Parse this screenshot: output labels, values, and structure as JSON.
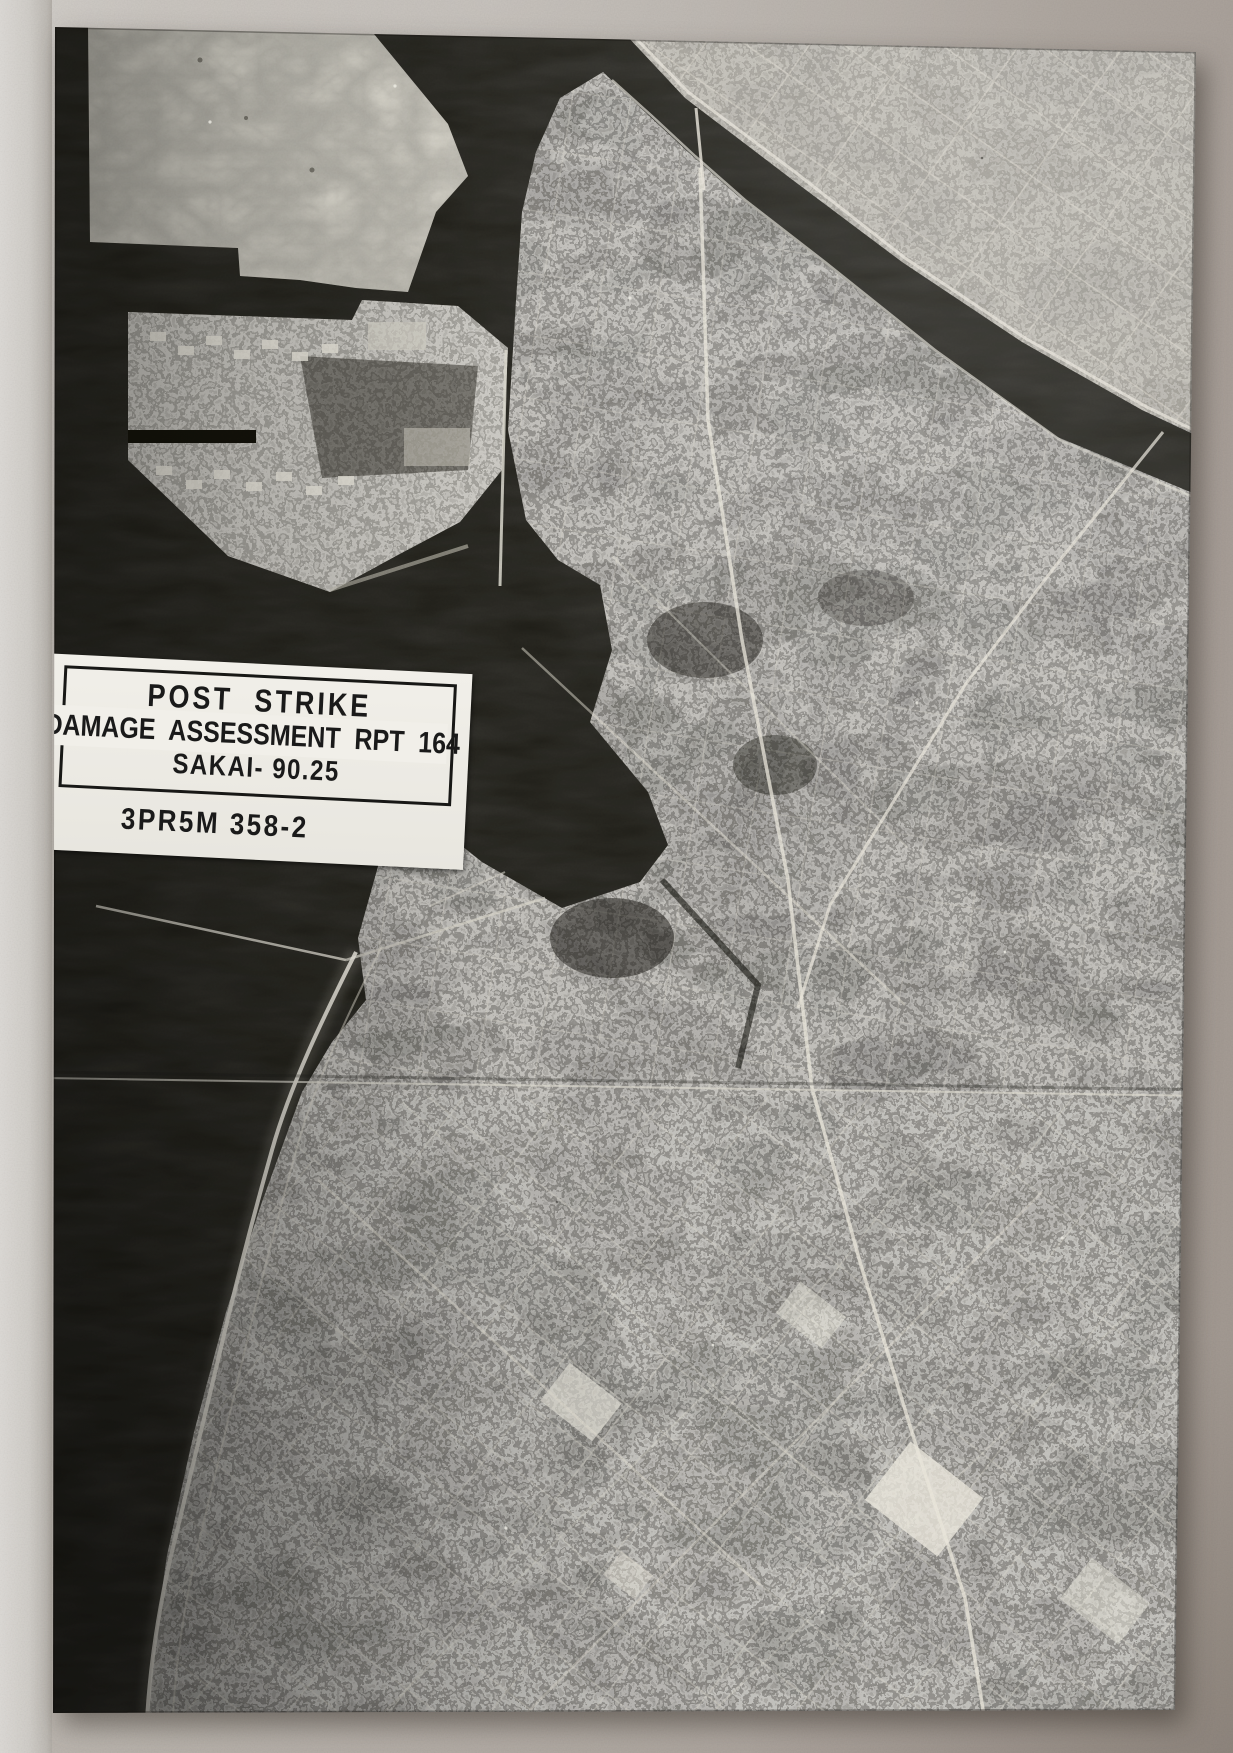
{
  "scene": {
    "description": "Black-and-white WWII aerial reconnaissance photograph print of Sakai, Japan (harbor, river, bombed city grid), lying on a gray table surface"
  },
  "photo_label": {
    "title": "POST STRIKE",
    "assessment_line": "DAMAGE ASSESSMENT RPT 164",
    "target_line": "SAKAI- 90.25",
    "reference_number": "3PR5M 358-2"
  },
  "colors": {
    "table-surface": "#b7b1aa",
    "paper-strip": "#d6d3ce",
    "water-dark": "#16150f",
    "print-midtone": "#8f8b81",
    "mudflat-light": "#d7d4c9",
    "label-background": "#f1efe9",
    "label-text": "#1a1a1a"
  }
}
